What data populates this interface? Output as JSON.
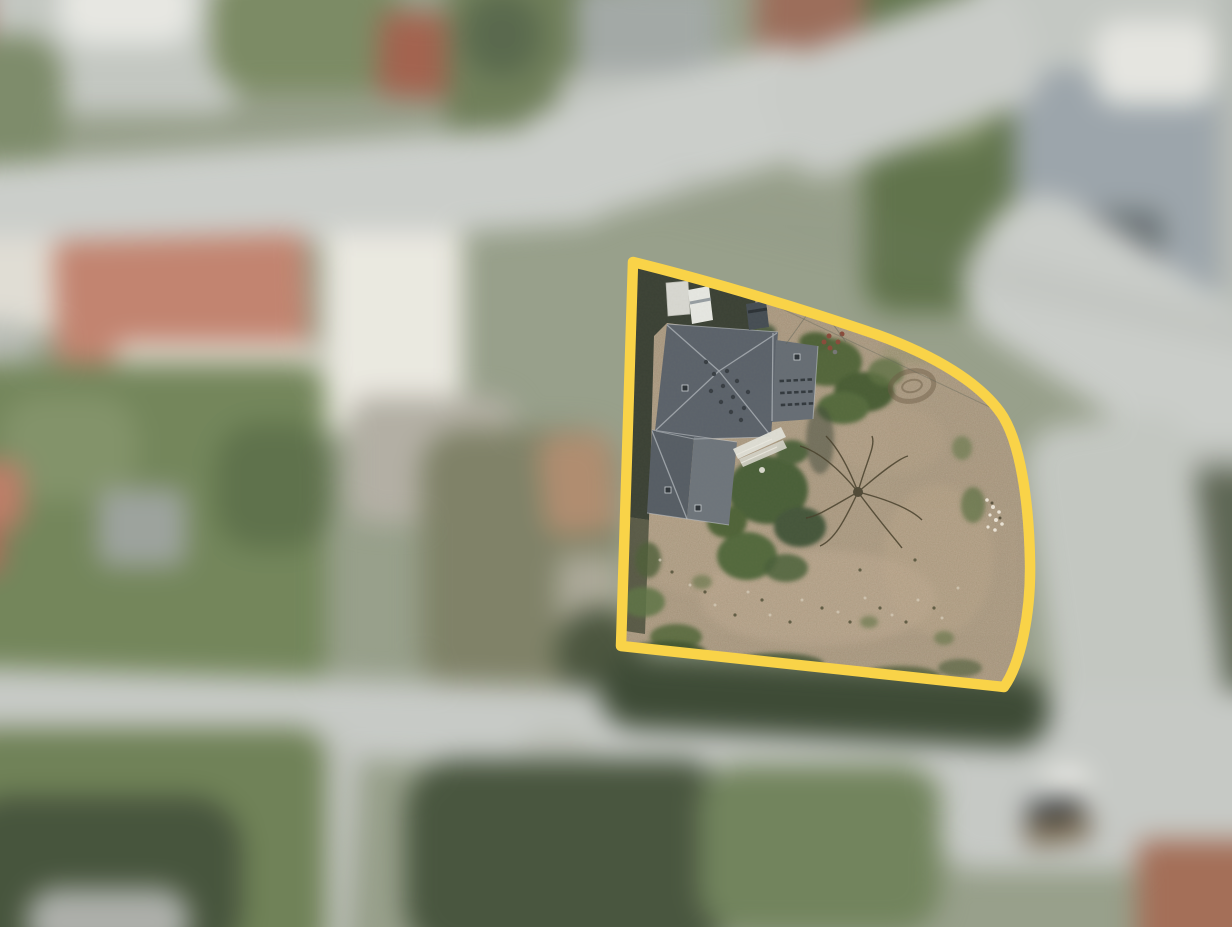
{
  "scene": {
    "type": "aerial-photograph",
    "description": "Top-down aerial photo of a residential neighborhood. A single land parcel is highlighted with a thick yellow boundary and shown in sharp focus; it contains a house with a dark gray hipped roof, a white van and trailer on a dark driveway, green bushes, a bare tree and a large bare-dirt yard. Everything outside the boundary (roads, red- and gray-roofed buildings, lawns, trees, parked cars) is heavily blurred.",
    "focus_region": "highlighted parcel",
    "background_state": "blurred"
  },
  "colors": {
    "boundary": "#F9D348",
    "dirt": "#A8927A",
    "roof_main": "#5B626B",
    "roof_wing": "#666D75",
    "roof_low_dark": "#565D65",
    "roof_low_light": "#6E757C",
    "road": "#C7CAC6",
    "lawn": "#708455",
    "red_roof": "#C4806A",
    "trees_dark": "#44533A",
    "white_building": "#E6E4DB",
    "hedge": "#5E7247"
  },
  "parcel": {
    "boundary_path": "M 633 262 C 718 283 812 312 878 335 C 936 356 979 383 1000 412 C 1021 441 1029 505 1030 562 C 1031 612 1021 663 1004 687 L 621 646 Z",
    "stroke_width": "10.5",
    "contains": [
      "gray-roof-house",
      "lower-wing-extension",
      "white-van",
      "white-trailer",
      "dark-car",
      "wooden-deck-stairs",
      "dark-driveway",
      "hedge-strip-left",
      "bush-clusters",
      "bare-tree",
      "dirt-yard",
      "stone-pile",
      "round-garden-feature",
      "overhead-power-lines"
    ]
  },
  "background": {
    "blur_px": 13,
    "elements": [
      "upper-road",
      "northeast-road",
      "bottom-road",
      "side-lanes",
      "red-roof-building-large",
      "white-building",
      "small-red-roofs",
      "brick-building-top",
      "gray-blue-building",
      "hedge-column",
      "large-lawn-left",
      "lawn-bottom-left",
      "tree-clusters",
      "white-van-parked",
      "dark-car-parked",
      "brick-building-bottom-right"
    ]
  }
}
